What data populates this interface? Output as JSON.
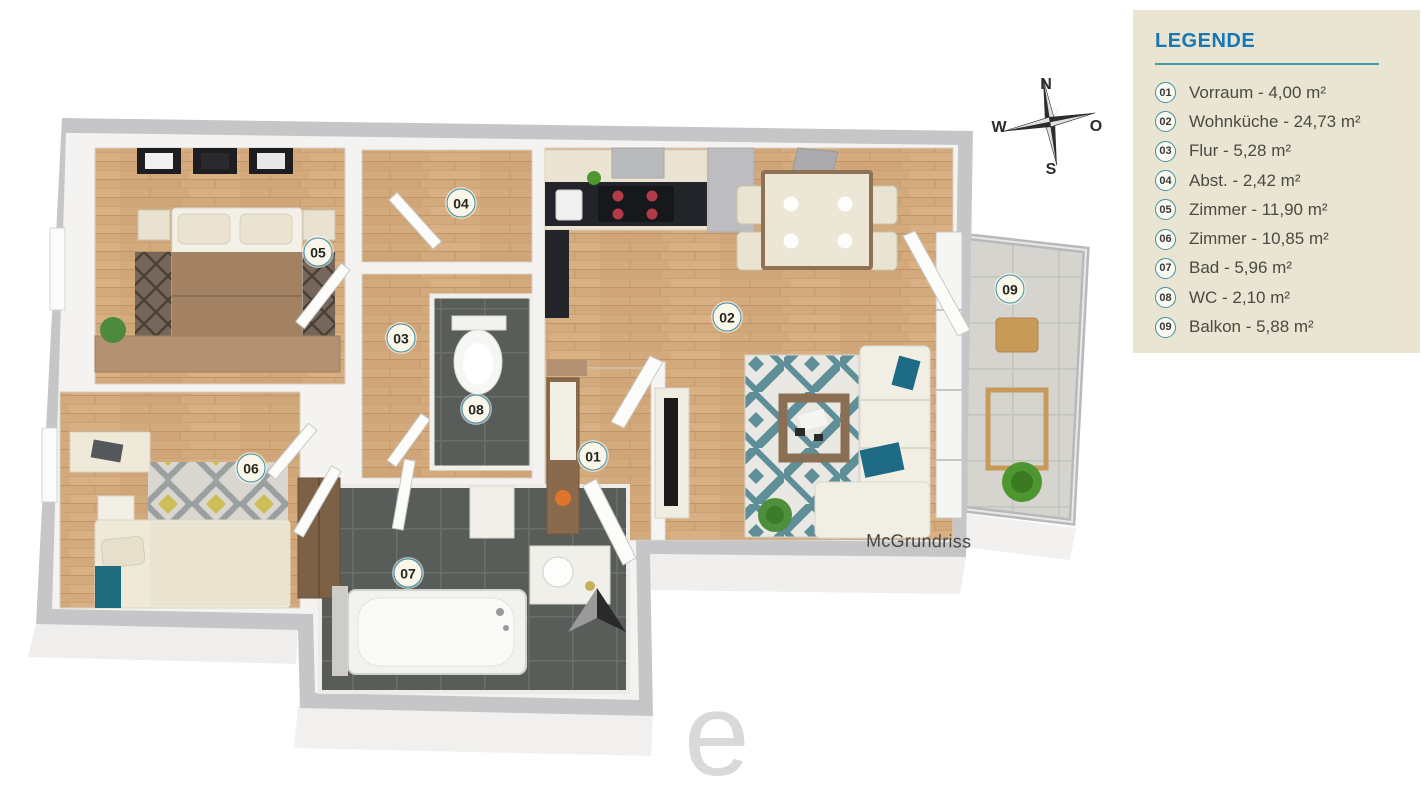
{
  "legend": {
    "title": "LEGENDE",
    "items": [
      {
        "number": "01",
        "label": "Vorraum - 4,00 m²"
      },
      {
        "number": "02",
        "label": "Wohnküche - 24,73 m²"
      },
      {
        "number": "03",
        "label": "Flur - 5,28 m²"
      },
      {
        "number": "04",
        "label": "Abst. - 2,42 m²"
      },
      {
        "number": "05",
        "label": "Zimmer - 11,90 m²"
      },
      {
        "number": "06",
        "label": "Zimmer - 10,85 m²"
      },
      {
        "number": "07",
        "label": "Bad - 5,96 m²"
      },
      {
        "number": "08",
        "label": "WC - 2,10 m²"
      },
      {
        "number": "09",
        "label": "Balkon - 5,88 m²"
      }
    ]
  },
  "compass": {
    "north": "N",
    "east": "O",
    "south": "S",
    "west": "W"
  },
  "plan": {
    "room_badges": [
      "01",
      "02",
      "03",
      "04",
      "05",
      "06",
      "07",
      "08",
      "09"
    ],
    "brand_watermark": "McGrundriss"
  },
  "watermark_letter": "e",
  "colors": {
    "legend_bg": "#eae5d2",
    "legend_title": "#1478b7",
    "legend_rule": "#4d9aab",
    "badge_ring": "#3e8fa0",
    "wall_gray": "#c6c6c8",
    "wood_floor": "#d2aa7c",
    "dark_tile": "#585d5a",
    "balcony_tile": "#d5d4cf",
    "accent_teal": "#1f6b86",
    "rug_teal": "#5e8e98",
    "rug_yellow": "#cdbf56"
  }
}
